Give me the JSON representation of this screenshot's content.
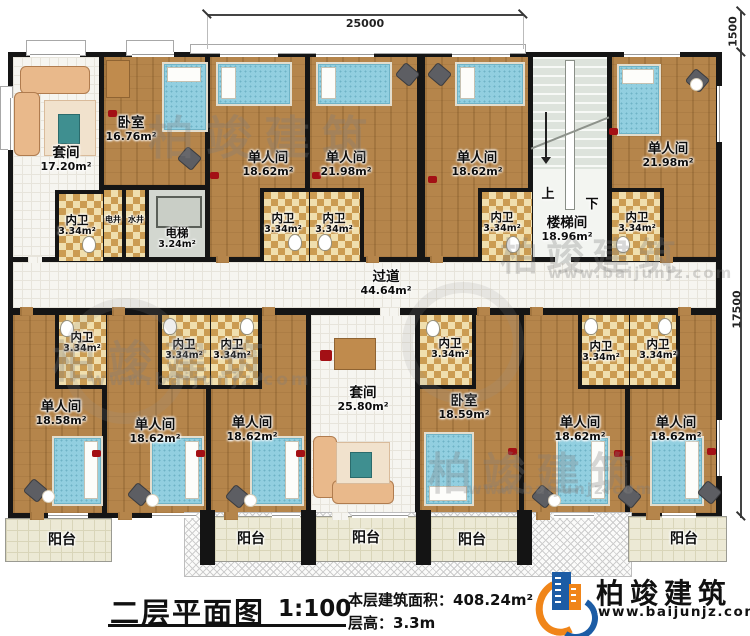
{
  "title_block": {
    "title": "二层平面图",
    "scale": "1:100",
    "area_label": "本层建筑面积：",
    "area_value": "408.24m²",
    "height_label": "层高：",
    "height_value": "3.3m"
  },
  "brand": {
    "name": "柏竣建筑",
    "website": "www.baijunjz.com",
    "blue": "#1c5ca5",
    "orange": "#f08519"
  },
  "dimensions": {
    "top_width": "25000",
    "right_top": "1500",
    "right_side": "17500"
  },
  "corridor": {
    "name": "过道",
    "area": "44.64m²"
  },
  "stairwell": {
    "name": "楼梯间",
    "area": "18.96m²",
    "up_label": "上",
    "down_label": "下"
  },
  "elevator": {
    "name": "电梯",
    "area": "3.24m²"
  },
  "shafts": [
    {
      "name": "电井"
    },
    {
      "name": "水井"
    }
  ],
  "rooms": {
    "top": [
      {
        "name": "套间",
        "area": "17.20m²"
      },
      {
        "name": "卧室",
        "area": "16.76m²"
      },
      {
        "name": "单人间",
        "area": "18.62m²"
      },
      {
        "name": "单人间",
        "area": "21.98m²"
      },
      {
        "name": "单人间",
        "area": "18.62m²"
      },
      {
        "name": "单人间",
        "area": "21.98m²"
      }
    ],
    "bottom": [
      {
        "name": "单人间",
        "area": "18.58m²"
      },
      {
        "name": "单人间",
        "area": "18.62m²"
      },
      {
        "name": "单人间",
        "area": "18.62m²"
      },
      {
        "name": "套间",
        "area": "25.80m²"
      },
      {
        "name": "卧室",
        "area": "18.59m²"
      },
      {
        "name": "单人间",
        "area": "18.62m²"
      },
      {
        "name": "单人间",
        "area": "18.62m²"
      }
    ]
  },
  "bathrooms": [
    {
      "name": "内卫",
      "area": "3.34m²"
    },
    {
      "name": "内卫",
      "area": "3.34m²"
    },
    {
      "name": "内卫",
      "area": "3.34m²"
    },
    {
      "name": "内卫",
      "area": "3.34m²"
    },
    {
      "name": "内卫",
      "area": "3.34m²"
    },
    {
      "name": "内卫",
      "area": "3.34m²"
    },
    {
      "name": "内卫",
      "area": "3.34m²"
    },
    {
      "name": "内卫",
      "area": "3.34m²"
    },
    {
      "name": "内卫",
      "area": "3.34m²"
    },
    {
      "name": "内卫",
      "area": "3.34m²"
    },
    {
      "name": "内卫",
      "area": "3.34m²"
    }
  ],
  "balconies": [
    {
      "name": "阳台"
    },
    {
      "name": "阳台"
    },
    {
      "name": "阳台"
    },
    {
      "name": "阳台"
    },
    {
      "name": "阳台"
    }
  ]
}
